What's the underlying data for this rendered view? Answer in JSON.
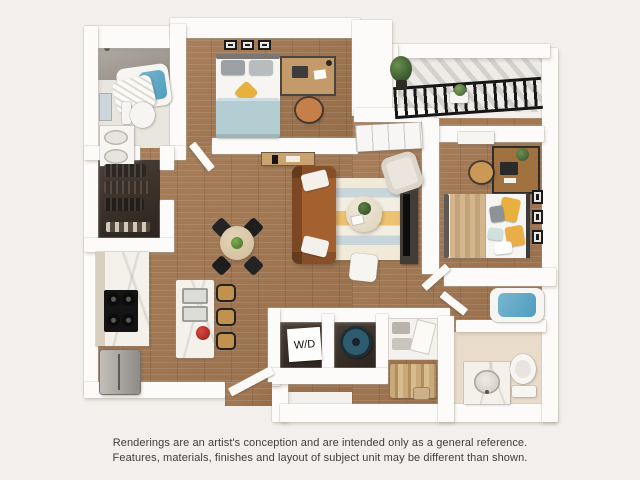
{
  "disclaimer": {
    "line1": "Renderings are an artist's conception and are intended only as a general reference.",
    "line2": "Features, materials, finishes and layout of subject unit may be different than shown."
  },
  "laundry": {
    "label": "W/D"
  },
  "rooms": {
    "bathroom_1": [
      "walk-in shower",
      "bathtub with curtain",
      "toilet",
      "vanity with two sinks",
      "mirror"
    ],
    "walk_in_closet": [
      "hanging clothes",
      "shoe shelf"
    ],
    "bedroom_1": [
      "bed with blue blanket and yellow pillow",
      "three wall frames",
      "desk with laptop",
      "office chair"
    ],
    "kitchen": [
      "wall counter",
      "cooktop",
      "refrigerator",
      "island with double sink",
      "three bar stools",
      "fruit bowl"
    ],
    "dining": [
      "round table",
      "four black chairs",
      "centerpiece plant"
    ],
    "living": [
      "brown sofa with white pillows",
      "striped rug",
      "round coffee table with plant",
      "white ottoman",
      "tv on media console",
      "console table"
    ],
    "den_nook": [
      "white cabinets",
      "cream armchair"
    ],
    "balcony": [
      "black metal railing",
      "potted plants",
      "small table"
    ],
    "bedroom_2": [
      "bed with tan striped blanket and yellow pillows",
      "desk with computer and plant",
      "chair",
      "three wall frames",
      "dresser"
    ],
    "laundry_closet": [
      "washer-dryer label",
      "washer drum"
    ],
    "closet_2": [
      "shelves with linens",
      "tan hanging clothes",
      "storage box"
    ],
    "bathroom_2": [
      "bathtub",
      "vanity sink",
      "toilet"
    ]
  },
  "colors": {
    "bg": "#f2efec",
    "wall": "#fcfbf9",
    "wood": "#a3764f",
    "tile": "#e9e5df",
    "shower": "#928c84",
    "water": "#4f9dc0",
    "sofa": "#a4602f",
    "blanket_blue": "#b3cdd3",
    "pillow_yellow": "#e8b03c",
    "washer_lid": "#2f5b6e",
    "rug_cream": "#f1ead9",
    "rug_blue": "#c8d5d9",
    "rug_yellow": "#ecc271",
    "closet_dark": "#3a2f27",
    "marble": "#f4f1ea",
    "cabinet_beige": "#d9cfc0",
    "clothes_tan": "#c9a97a",
    "text": "#3f3c3a"
  }
}
